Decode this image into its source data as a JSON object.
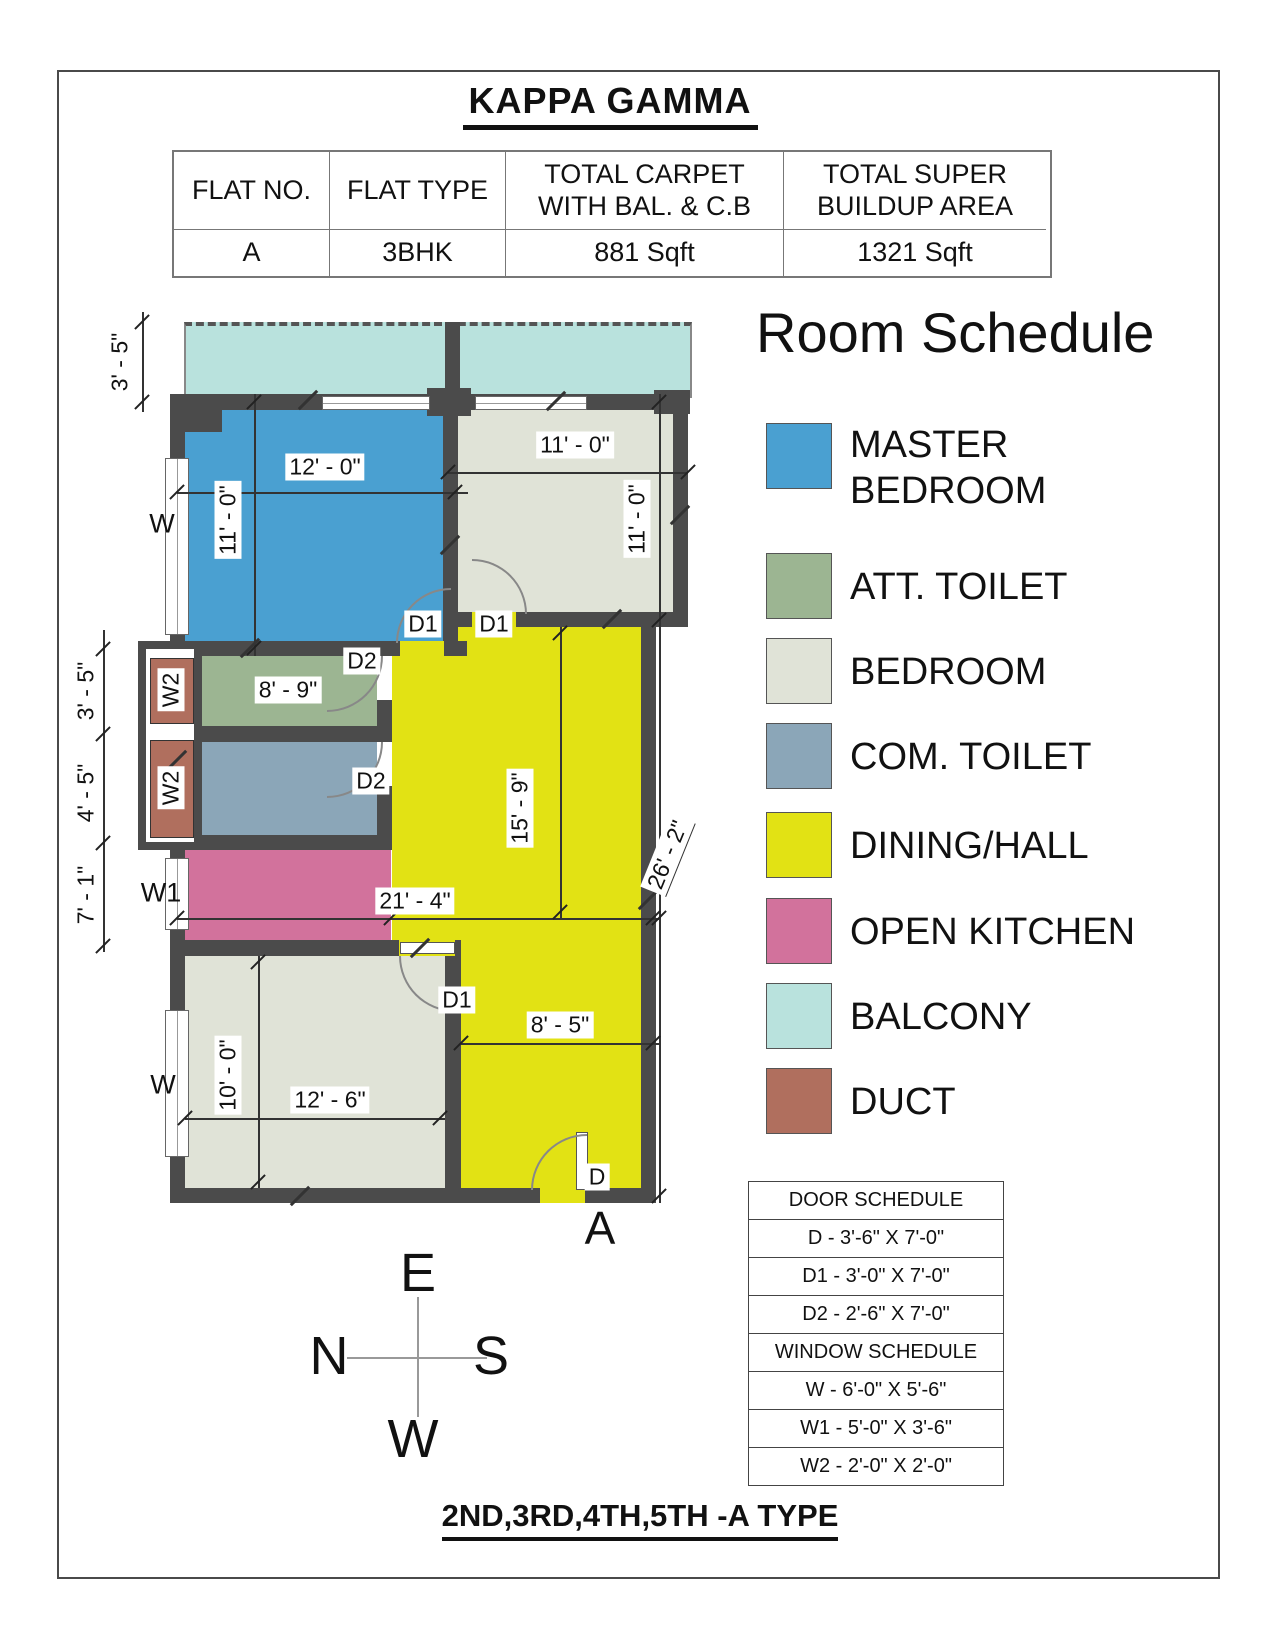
{
  "page": {
    "title": "KAPPA GAMMA",
    "footer": "2ND,3RD,4TH,5TH -A TYPE"
  },
  "info_table": {
    "headers": [
      "FLAT NO.",
      "FLAT TYPE",
      "TOTAL CARPET WITH BAL. & C.B",
      "TOTAL SUPER BUILDUP AREA"
    ],
    "row": [
      "A",
      "3BHK",
      "881 Sqft",
      "1321 Sqft"
    ]
  },
  "room_schedule": {
    "title": "Room Schedule",
    "items": [
      {
        "label": "MASTER BEDROOM",
        "color": "#4aa0d1"
      },
      {
        "label": "ATT. TOILET",
        "color": "#9cb592"
      },
      {
        "label": "BEDROOM",
        "color": "#e0e3d7"
      },
      {
        "label": "COM. TOILET",
        "color": "#8ba6b8"
      },
      {
        "label": "DINING/HALL",
        "color": "#e2e214"
      },
      {
        "label": "OPEN KITCHEN",
        "color": "#d2729c"
      },
      {
        "label": "BALCONY",
        "color": "#b9e2dd"
      },
      {
        "label": "DUCT",
        "color": "#b06f5e"
      }
    ]
  },
  "plan": {
    "wall_color": "#4b4b4b",
    "dims": {
      "balcony_h": "3' - 5\"",
      "mbr_w": "12' - 0\"",
      "mbr_h": "11' - 0\"",
      "br1_w": "11' - 0\"",
      "br1_h": "11' - 0\"",
      "att_w": "8' - 9\"",
      "duct_top": "3' - 5\"",
      "duct_bottom": "4' - 5\"",
      "kitchen_h": "7' - 1\"",
      "hall_h": "15' - 9\"",
      "hall_w": "21' - 4\"",
      "overall_h": "26' - 2\"",
      "passage_w": "8' - 5\"",
      "br2_w": "12' - 6\"",
      "br2_h": "10' - 0\""
    },
    "doors": {
      "d": "D",
      "d1": "D1",
      "d2": "D2"
    },
    "windows": {
      "w": "W",
      "w1": "W1",
      "w2": "W2"
    },
    "entrance": "A",
    "compass": {
      "top": "E",
      "left": "N",
      "right": "S",
      "bottom": "W"
    }
  },
  "door_schedule": {
    "rows": [
      "DOOR SCHEDULE",
      "D - 3'-6\" X 7'-0\"",
      "D1 - 3'-0\" X 7'-0\"",
      "D2 - 2'-6\" X 7'-0\"",
      "WINDOW SCHEDULE",
      "W - 6'-0\" X 5'-6\"",
      "W1 - 5'-0\" X 3'-6\"",
      "W2 - 2'-0\" X 2'-0\""
    ]
  }
}
